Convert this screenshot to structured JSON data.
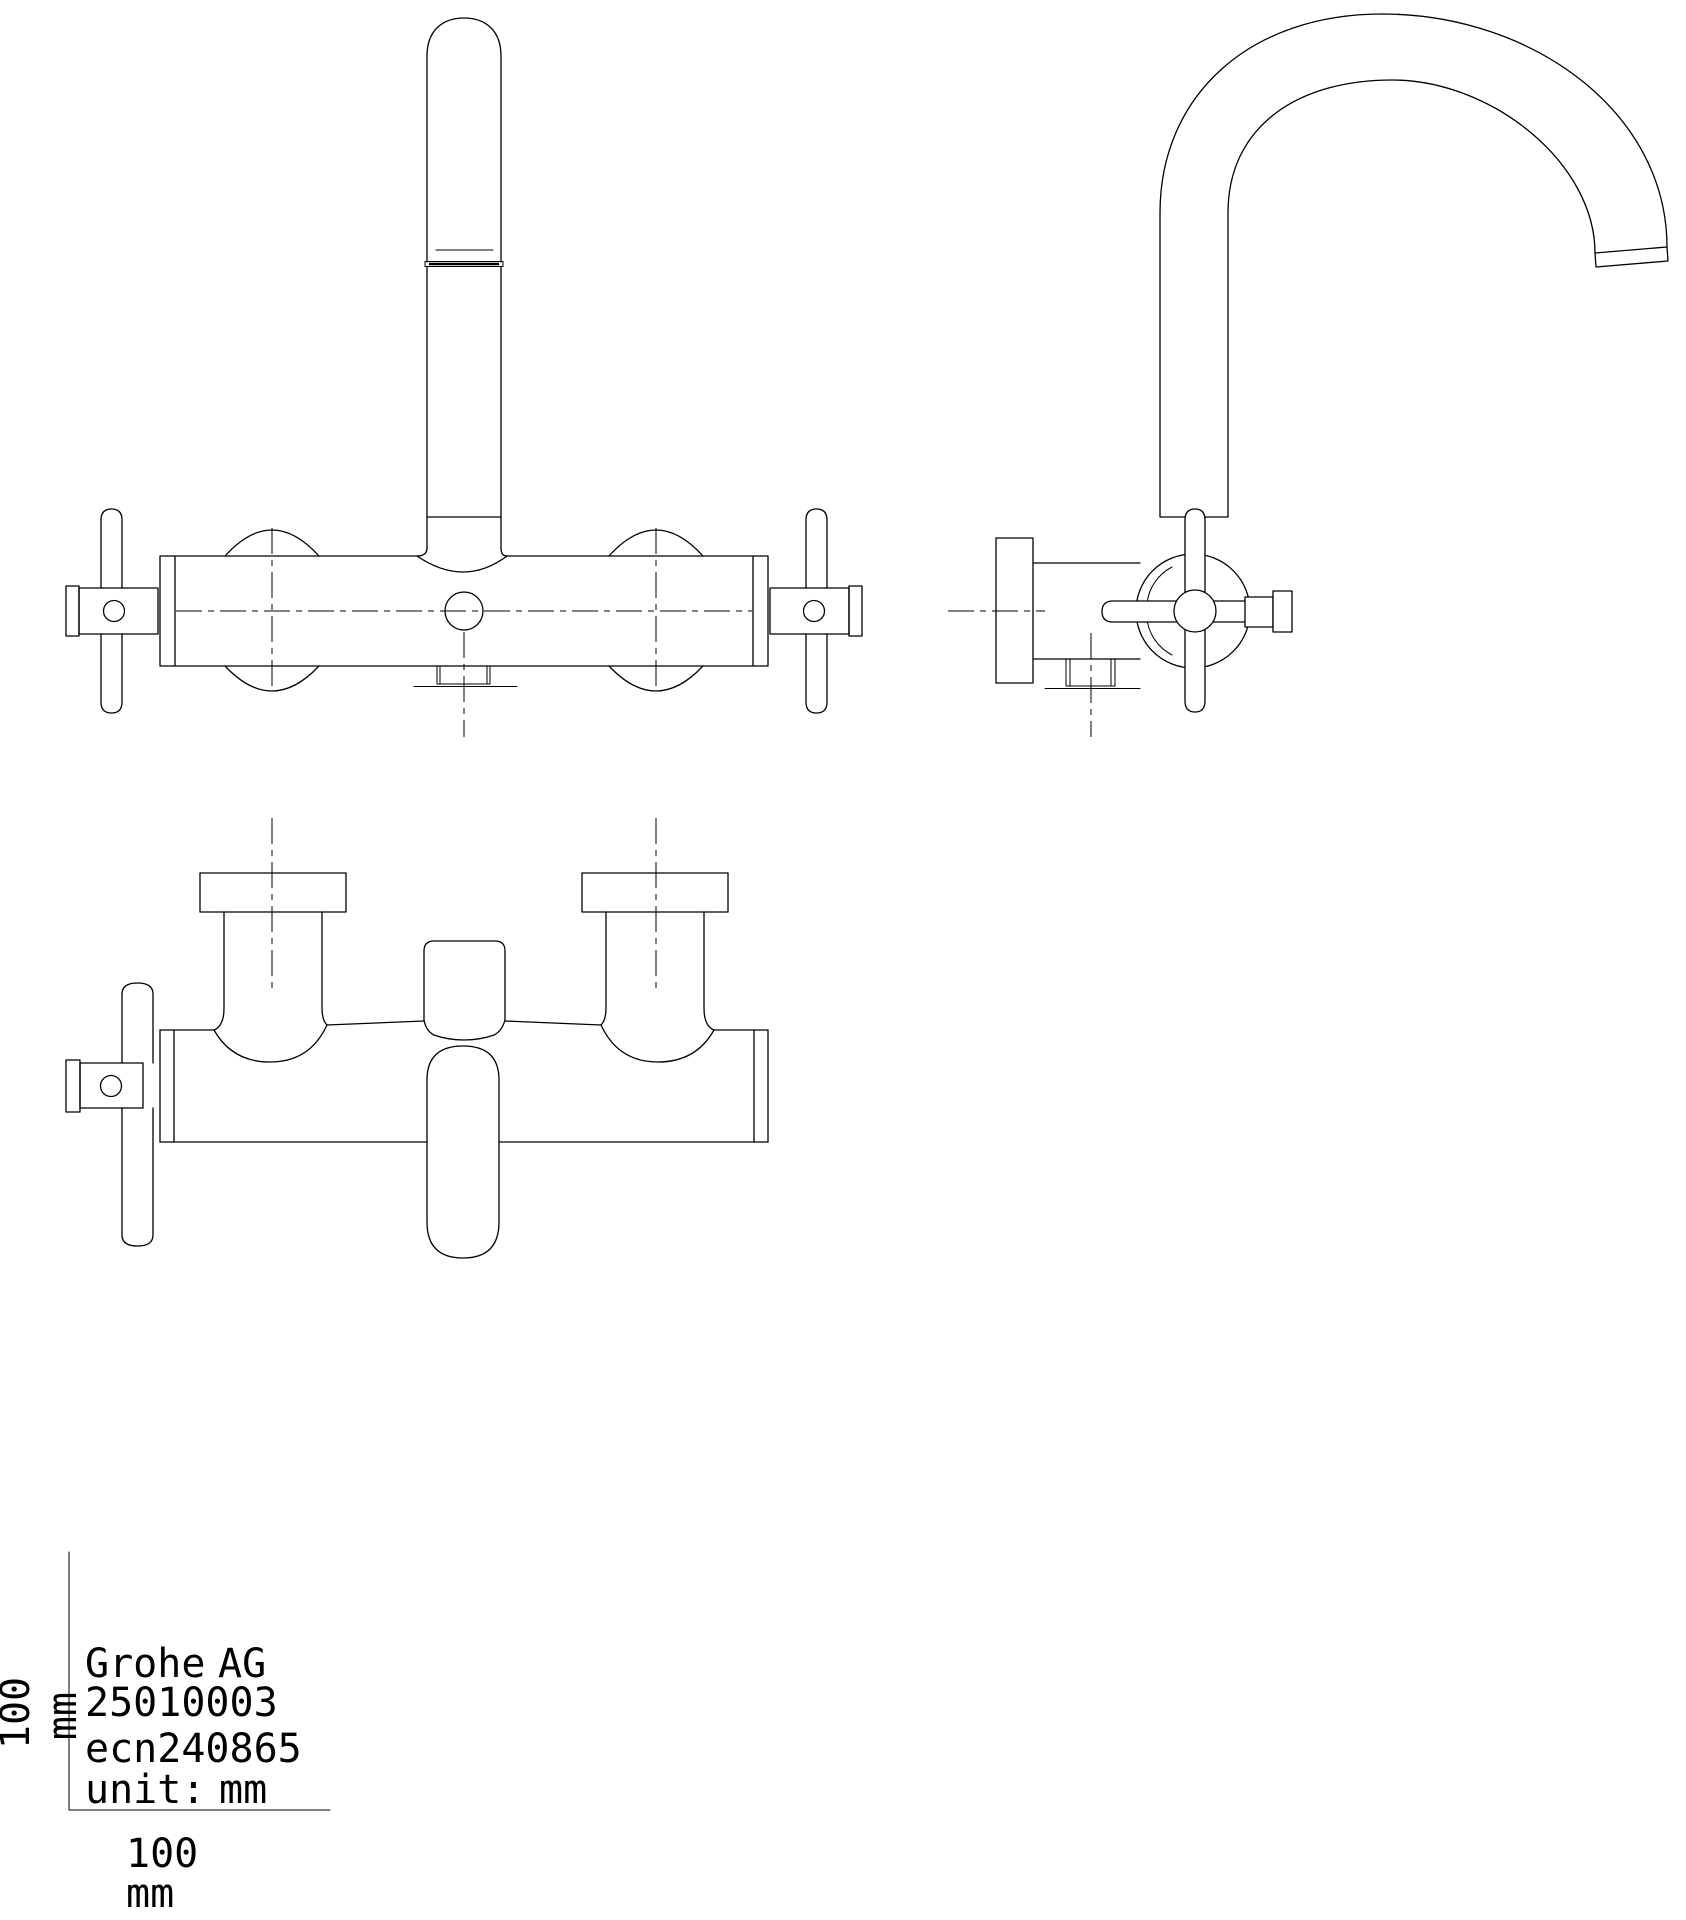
{
  "drawing": {
    "ink_color": "#000000",
    "paper_color": "#ffffff"
  },
  "title_block": {
    "company_name": "Grohe",
    "company_suffix": "AG",
    "part_number": "25010003",
    "revision": "ecn240865",
    "unit_label": "unit:",
    "unit_value": "mm"
  },
  "scale_axes": {
    "y_axis_value": "100",
    "y_axis_unit": "mm",
    "x_axis_value": "100",
    "x_axis_unit": "mm"
  }
}
